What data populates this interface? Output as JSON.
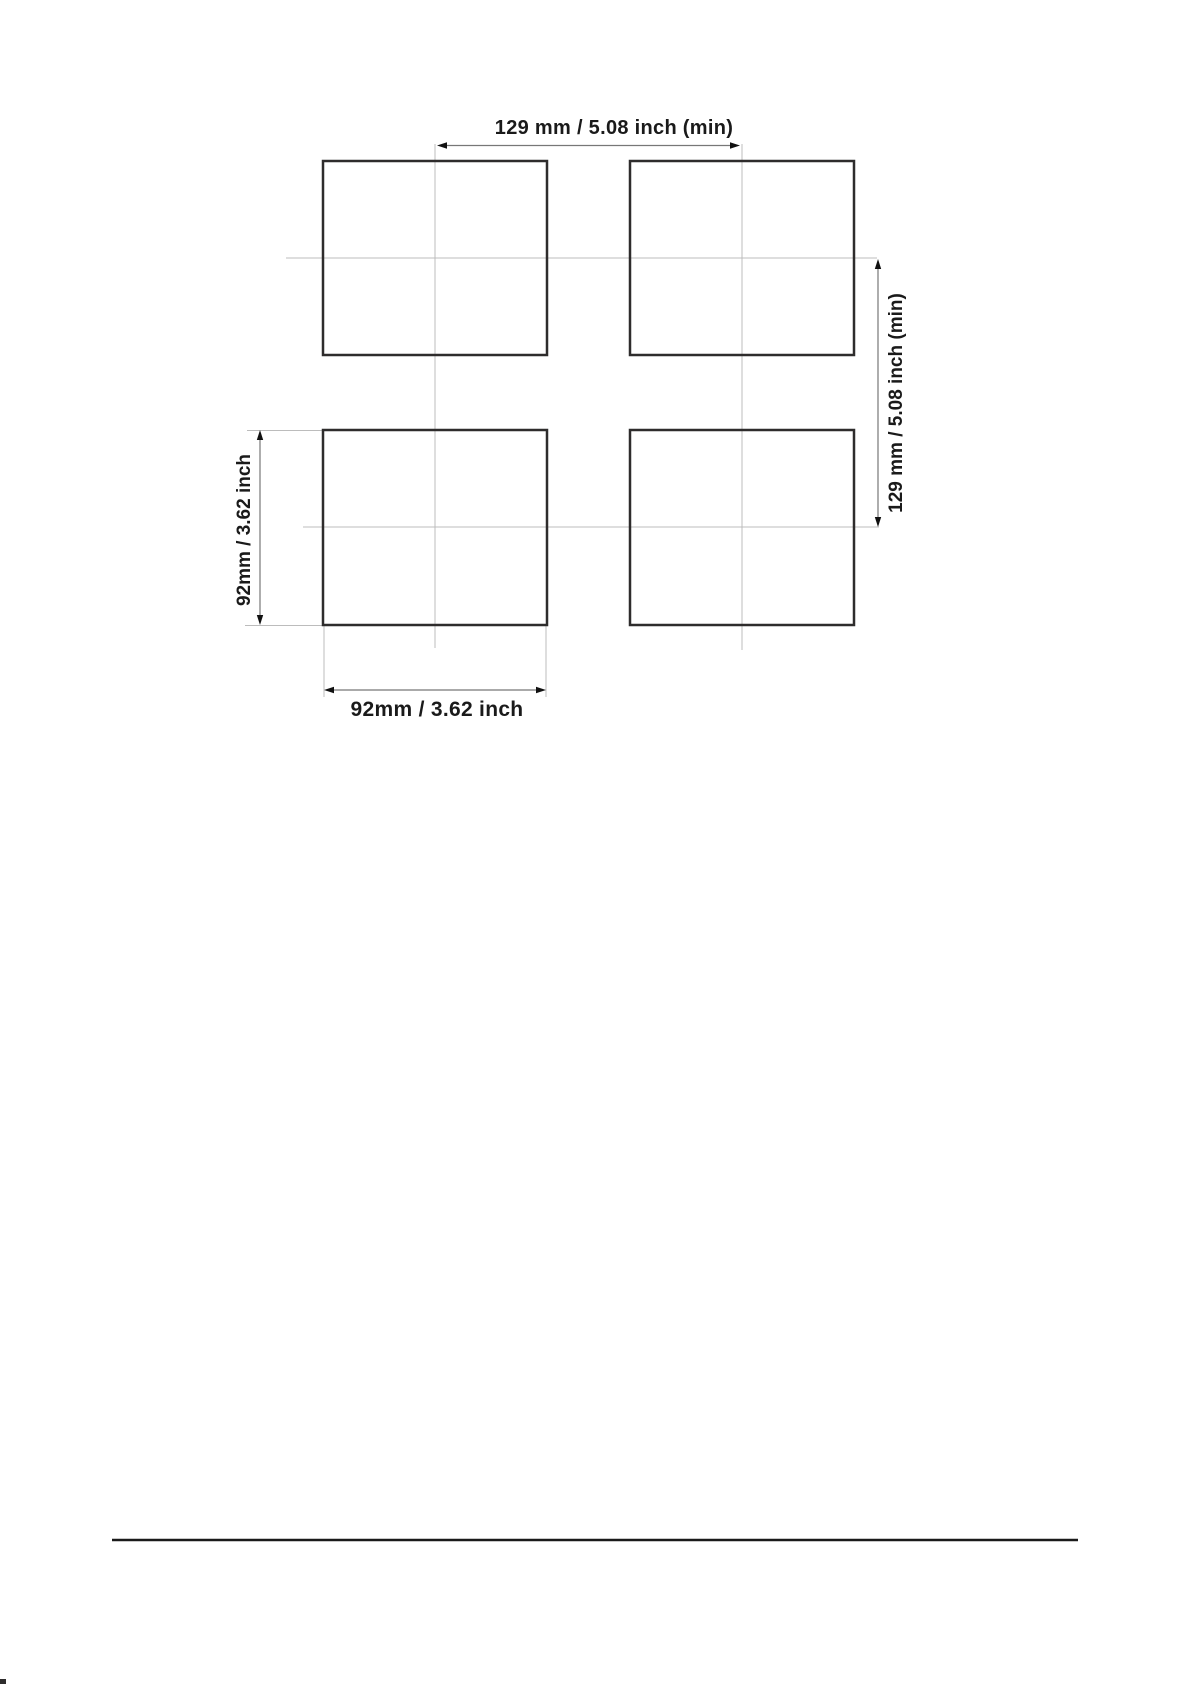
{
  "diagram": {
    "title_semantic": "panel-cutout-mounting-spacing-diagram",
    "labels": {
      "top": "129 mm / 5.08 inch (min)",
      "right": "129 mm / 5.08 inch (min)",
      "left": "92mm / 3.62 inch",
      "bottom": "92mm / 3.62 inch"
    },
    "colors": {
      "outline": "#2e2c2c",
      "dimension_line": "#777777",
      "centerline": "#bcbcbc",
      "arrow": "#111111",
      "text": "#1a1a1a",
      "rule": "#1a1a1a"
    }
  }
}
